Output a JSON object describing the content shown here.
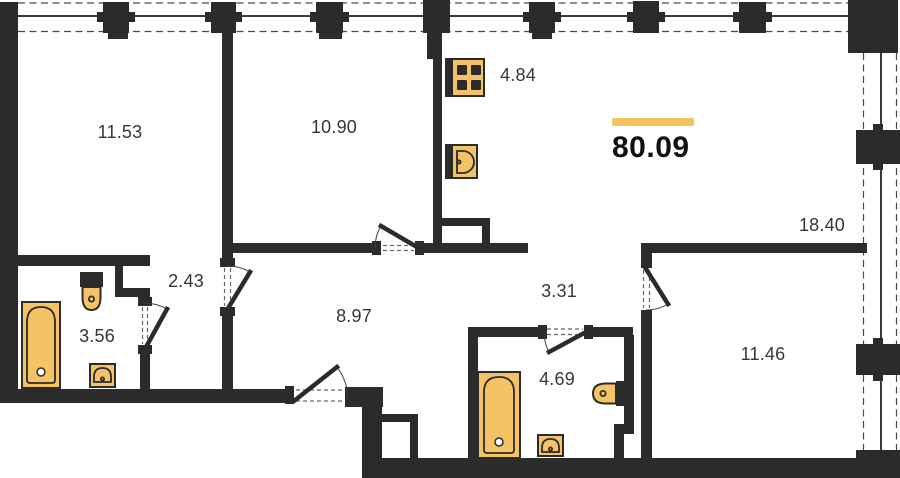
{
  "total": {
    "value": "80.09",
    "accent_color": "#f3c35f"
  },
  "rooms": [
    {
      "name": "bedroom-top-left",
      "area": "11.53"
    },
    {
      "name": "room-top-middle",
      "area": "10.90"
    },
    {
      "name": "kitchen-zone",
      "area": "4.84"
    },
    {
      "name": "living-zone",
      "area": "18.40"
    },
    {
      "name": "wardrobe-corridor",
      "area": "2.43"
    },
    {
      "name": "bathroom-left",
      "area": "3.56"
    },
    {
      "name": "hallway",
      "area": "8.97"
    },
    {
      "name": "hall-small",
      "area": "3.31"
    },
    {
      "name": "bathroom-right",
      "area": "4.69"
    },
    {
      "name": "bedroom-bottom-right",
      "area": "11.46"
    }
  ],
  "fixtures": {
    "kitchen": [
      "stove",
      "sink"
    ],
    "bathroom_left": [
      "bathtub",
      "toilet",
      "washbasin"
    ],
    "bathroom_right": [
      "bathtub",
      "toilet",
      "washbasin"
    ]
  },
  "colors": {
    "wall": "#2b2b2b",
    "fixture": "#f4c366",
    "background": "#ffffff"
  }
}
